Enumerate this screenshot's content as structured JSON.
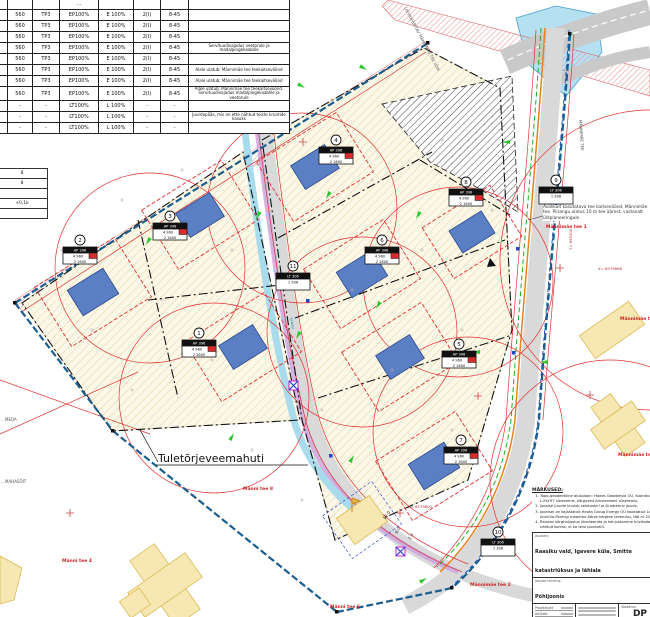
{
  "land_use_table": {
    "rows": [
      [
        "",
        "",
        "",
        "…",
        "",
        "",
        "",
        ""
      ],
      [
        "",
        "560",
        "TP3",
        "EP100%",
        "E 100%",
        "2(I)",
        "8-45",
        ""
      ],
      [
        "",
        "560",
        "TP3",
        "EP100%",
        "E 100%",
        "2(I)",
        "8-45",
        ""
      ],
      [
        "",
        "560",
        "TP3",
        "EP100%",
        "E 100%",
        "2(I)",
        "8-45",
        ""
      ],
      [
        "",
        "560",
        "TP3",
        "EP100%",
        "E 100%",
        "2(I)",
        "8-45",
        "Servituudivajadus veetorule ja madalpingekaablile"
      ],
      [
        "",
        "560",
        "TP3",
        "EP100%",
        "E 100%",
        "2(I)",
        "8-45",
        ""
      ],
      [
        "",
        "560",
        "TP3",
        "EP100%",
        "E 100%",
        "2(I)",
        "8-45",
        "Alale ulatub: Männimäe tee teekaitsevöönd"
      ],
      [
        "",
        "560",
        "TP3",
        "EP100%",
        "E 100%",
        "2(I)",
        "8-45",
        "Alale ulatub: Männimäe tee teekaitsevöönd"
      ],
      [
        "",
        "560",
        "TP3",
        "EP100%",
        "E 100%",
        "2(I)",
        "8-45",
        "Alale ulatub: Männimäe tee teekaitsevöönd. Servituudivajadus madalpingekaablile ja veetorule"
      ],
      [
        "",
        "-",
        "-",
        "LT100%",
        "L 100%",
        "-",
        "-",
        ""
      ],
      [
        "",
        "-",
        "-",
        "LT100%",
        "L 100%",
        "-",
        "-",
        "Juurdepääs, mis on ette nähtud teiste kruntide kasuks"
      ],
      [
        "",
        "-",
        "-",
        "LT100%",
        "L 100%",
        "-",
        "-",
        ""
      ]
    ]
  },
  "mini_table": {
    "rows": [
      [
        "8"
      ],
      [
        "8"
      ],
      [
        ""
      ],
      [
        "+0,1k"
      ],
      [
        ""
      ]
    ]
  },
  "plan": {
    "plots": [
      {
        "no": "1",
        "h": "AP 396",
        "r1": "4   960",
        "r2": "2   1600"
      },
      {
        "no": "2",
        "h": "AP 396",
        "r1": "4   960",
        "r2": "2   1600"
      },
      {
        "no": "3",
        "h": "AP 396",
        "r1": "4   960",
        "r2": "2   1600"
      },
      {
        "no": "4",
        "h": "AP 396",
        "r1": "4   960",
        "r2": "2   1600"
      },
      {
        "no": "5",
        "h": "AP 396",
        "r1": "4   960",
        "r2": "2   1600"
      },
      {
        "no": "6",
        "h": "AP 396",
        "r1": "4   960",
        "r2": "2   1600"
      },
      {
        "no": "7",
        "h": "AP 396",
        "r1": "4   960",
        "r2": "2   1600"
      },
      {
        "no": "8",
        "h": "AP 396",
        "r1": "4   960",
        "r2": "2   1600"
      },
      {
        "no": "9",
        "h": "LT 306",
        "r1": "1   306",
        "r2": ""
      },
      {
        "no": "10",
        "h": "LT 306",
        "r1": "1   306",
        "r2": ""
      },
      {
        "no": "11",
        "h": "LT 306",
        "r1": "1   306",
        "r2": ""
      }
    ],
    "labels": {
      "tuletorje": "Tuletõrjeveemahuti",
      "top_rotated": "LIKVIDEERITAV MÄNNIMÄE TEE LÕIK",
      "road_name_vertical": "MÄNNIMÄE TEE",
      "kraav": "kraav",
      "left_1": "…MEDA",
      "left_2": "…MAHASÕIT",
      "note_right": "Avalikult kasutatava tee kaitsevöönd, Männimäe tee. Piirangu ulatus 10 m tee äärest, vastavalt üldplaneeringule",
      "dims": [
        "13.0",
        "6.0",
        "2.4"
      ],
      "coords": [
        "X= 6579868",
        "Y= 659300",
        "X= 6579600"
      ],
      "addresses": [
        "Männi tee 8",
        "Männi tee 4",
        "Männimäe tee 2",
        "Männimäe tee 3",
        "Männimäe tee 5",
        "Männi tee 6",
        "Männimäe tee 1"
      ]
    }
  },
  "notes_block": {
    "heading": "MÄRKUSED:",
    "items": [
      "Topo-geodeetiline alusplaan: Hades Geodeesia OÜ. Koordinaadid L-Est'97 süsteemis, kõrgused Amsterdami süsteemis.",
      "Joonise juurde kuulub seletuskiri ja illustreeriv joonis.",
      "Joonisel on kajastatud Hepta Group Energy OÜ koostatud Lagedi-Aruküla-Peningi maantee äärse kergtee lahendus, töö nr 22375.",
      "Raiutav kõrghaljastus likvideerida ja kahjustamine hüvitada ette nähtud korras; vt ka teisi jooniseid."
    ]
  },
  "title_block": {
    "location_label": "Asukoht:",
    "location": "Raasiku vald, Igavere küla, Smitte katastriüksus ja lähiala",
    "drawing_label": "Joonise nimetus:",
    "drawing": "Põhijoonis",
    "roles": [
      "Projektijuht",
      "Arhitekt",
      "Koostaja"
    ],
    "stage_label": "Staadium",
    "stage": "DP",
    "date_label": "Kuupäev",
    "date": "16.10.2013"
  }
}
